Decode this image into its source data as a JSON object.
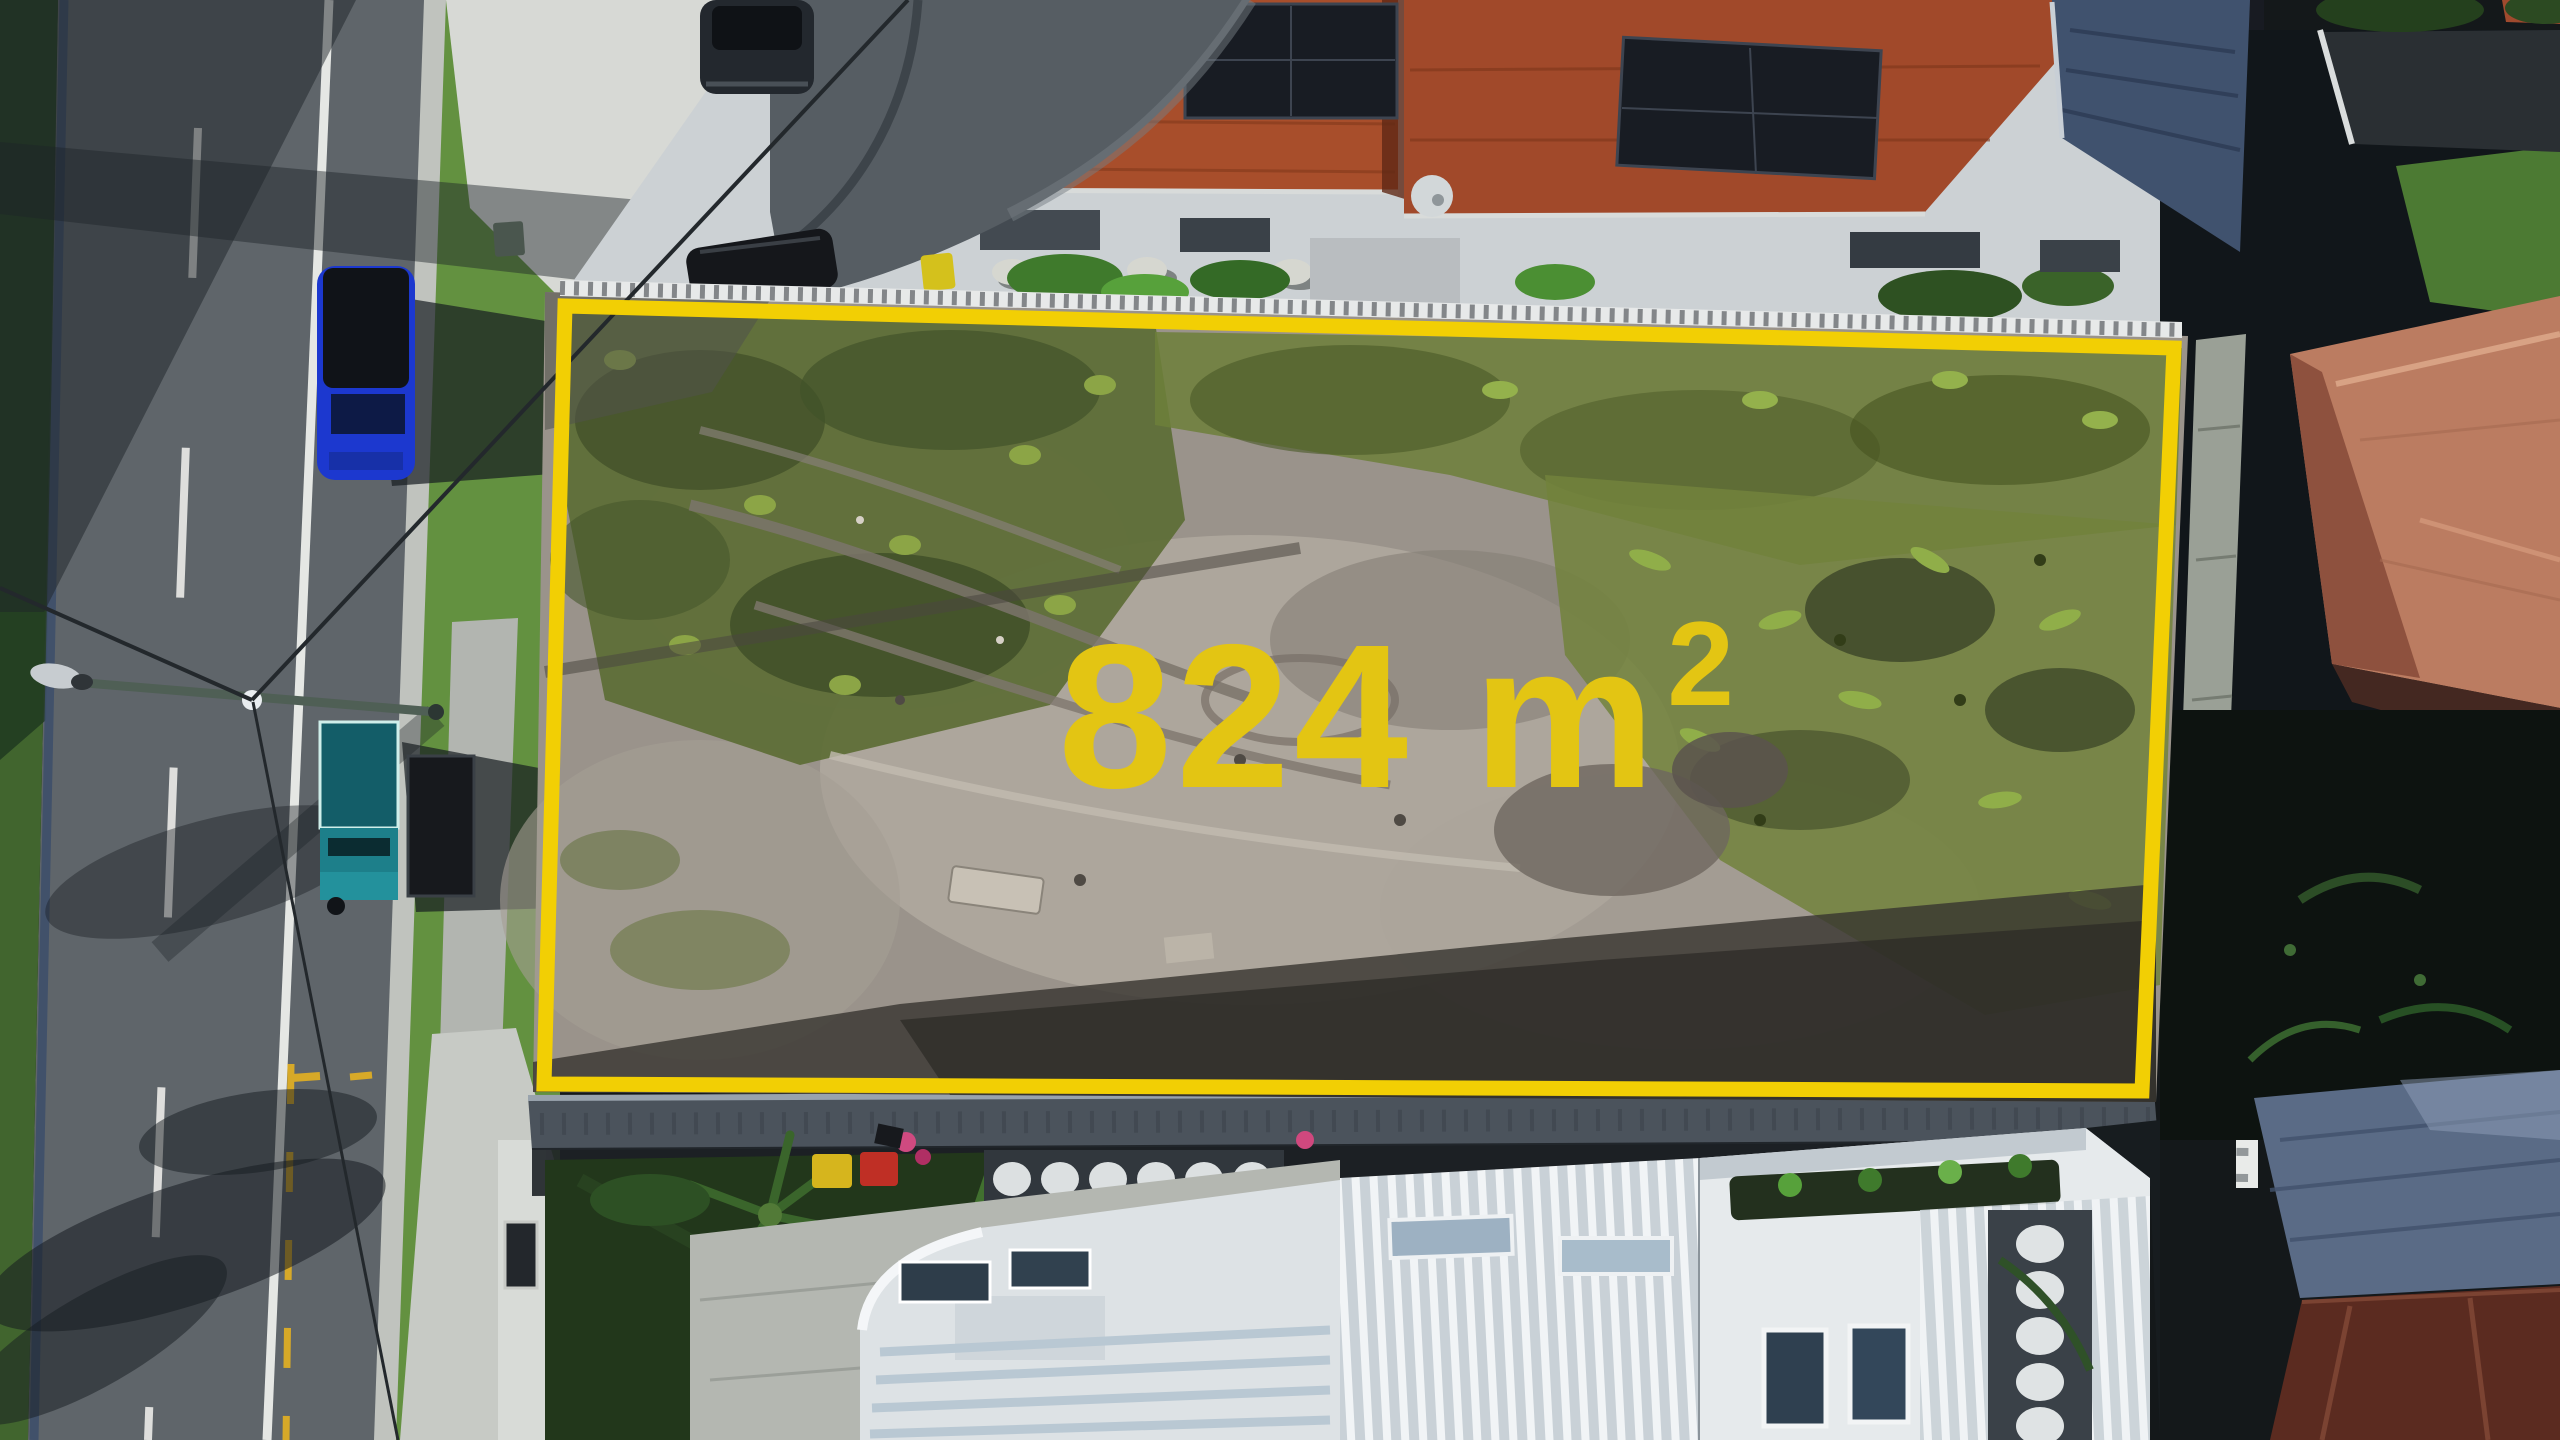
{
  "photo": {
    "kind": "aerial-drone-photo",
    "description": "Top-down drone photo of a rectangular vacant land parcel outlined in yellow. A two-lane road with parked vehicles runs along the left, terracotta-tiled duplex roofs with solar panels and a grey shade sail sit above the lot, a modern white house with ribbed roofing sits below, and neighbouring homes with salmon and metal roofs lie to the right."
  },
  "overlay": {
    "area_label": "824 m²",
    "area_value": "824 m",
    "area_exponent": "2",
    "boundary_color": "#F2CF04",
    "label_color": "#E3C513"
  },
  "palette": {
    "asphalt": "#5F656A",
    "sand": "#9A938B",
    "weeds": "#6D7F39",
    "terracotta_roof": "#A84E2B",
    "salmon_roof": "#BB7C61",
    "solar_panel": "#181C23",
    "white_house": "#E2E6E8",
    "shade_sail": "#565D63",
    "blue_car": "#1C38CF",
    "teal_ute": "#1D7F8A"
  }
}
